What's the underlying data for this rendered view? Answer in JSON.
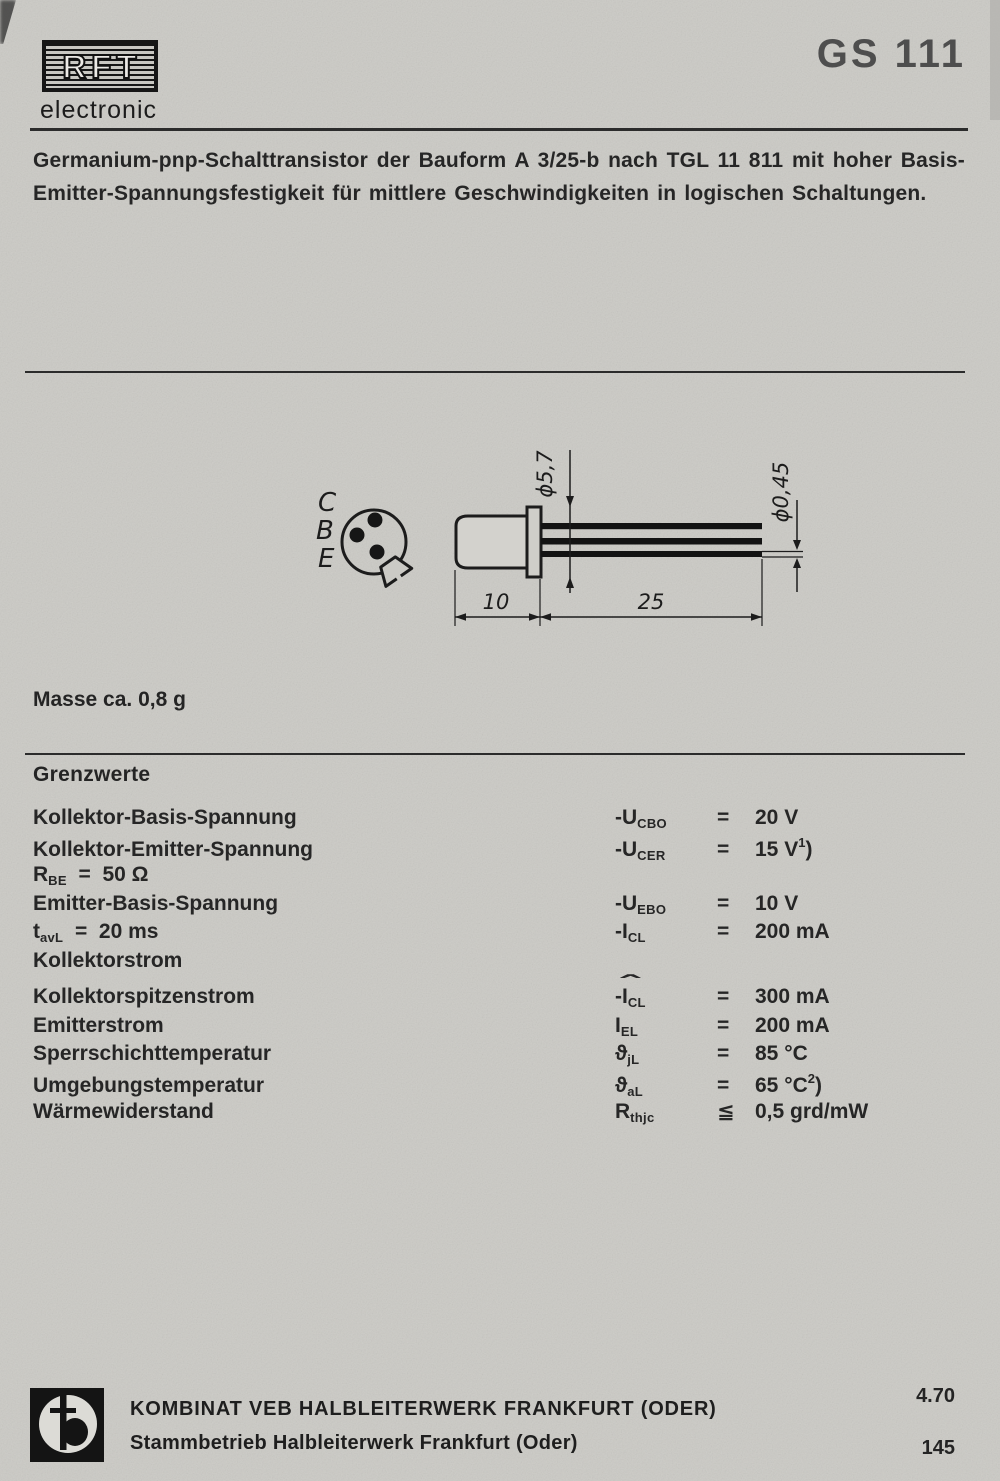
{
  "brand": {
    "logo_text": "RFT",
    "logo_sub": "electronic"
  },
  "part_number": "GS 111",
  "description_lines": [
    "Germanium-pnp-Schalttransistor der Bauform A 3/25-b nach TGL 11 811 mit hoher Basis-",
    "Emitter-Spannungsfestigkeit für mittlere Geschwindigkeiten in logischen Schaltungen."
  ],
  "drawing": {
    "pins": [
      "C",
      "B",
      "E"
    ],
    "dim_diameter_body": "ϕ5,7",
    "dim_diameter_lead": "ϕ0,45",
    "dim_body_length": "10",
    "dim_lead_length": "25"
  },
  "mass_note": "Masse ca. 0,8 g",
  "limits": {
    "heading": "Grenzwerte",
    "rows": [
      {
        "label": "Kollektor-Basis-Spannung",
        "sym_main": "-U",
        "sym_sub": "CBO",
        "rel": "=",
        "value": "20 V"
      },
      {
        "label": "Kollektor-Emitter-Spannung",
        "sym_main": "-U",
        "sym_sub": "CER",
        "rel": "=",
        "value": "15 V",
        "value_sup": "1",
        "value_close": ")"
      },
      {
        "cond_pre": "R",
        "cond_sub": "BE",
        "cond_post": "  =  50 Ω"
      },
      {
        "label": "Emitter-Basis-Spannung",
        "sym_main": "-U",
        "sym_sub": "EBO",
        "rel": "=",
        "value": "10 V"
      },
      {
        "cond_pre": "t",
        "cond_sub": "avL",
        "cond_post": "  =  20 ms",
        "sym_main": "-I",
        "sym_sub": "CL",
        "rel": "=",
        "value": "200 mA"
      },
      {
        "label": "Kollektorstrom"
      },
      {
        "label": "Kollektorspitzenstrom",
        "sym_hat": "ˆ",
        "sym_main": "-I",
        "sym_sub": "CL",
        "rel": "=",
        "value": "300 mA"
      },
      {
        "label": "Emitterstrom",
        "sym_main": "I",
        "sym_sub": "EL",
        "rel": "=",
        "value": "200 mA"
      },
      {
        "label": "Sperrschichttemperatur",
        "sym_main": "ϑ",
        "sym_sub": "jL",
        "rel": "=",
        "value": "85 °C"
      },
      {
        "label": "Umgebungstemperatur",
        "sym_main": "ϑ",
        "sym_sub": "aL",
        "rel": "=",
        "value": "65 °C",
        "value_sup": "2",
        "value_close": ")"
      },
      {
        "label": "Wärmewiderstand",
        "sym_main": "R",
        "sym_sub": "thjc",
        "rel": "≦",
        "value": "0,5 grd/mW"
      }
    ]
  },
  "footer": {
    "company_line1": "KOMBINAT VEB HALBLEITERWERK FRANKFURT (ODER)",
    "company_line2": "Stammbetrieb Halbleiterwerk Frankfurt (Oder)",
    "date_code": "4.70",
    "page_number": "145"
  },
  "colors": {
    "paper": "#cbcac5",
    "ink": "#1c1c1c"
  }
}
